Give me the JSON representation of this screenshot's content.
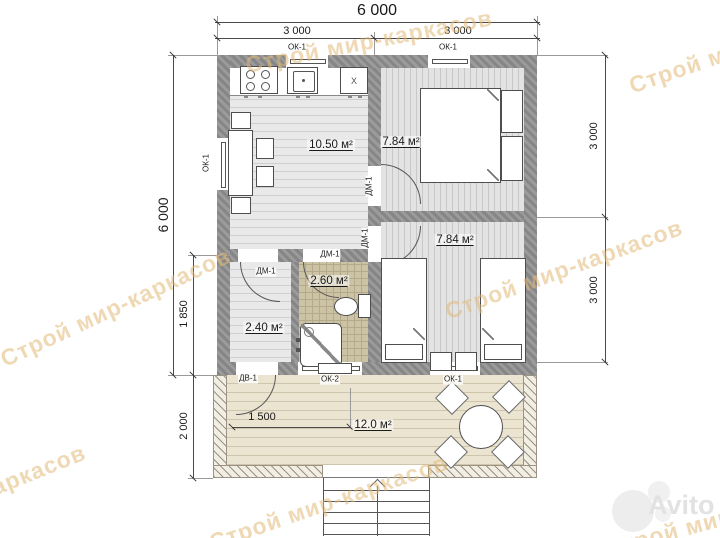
{
  "watermark": {
    "text": "Строй мир-каркасов"
  },
  "brand": {
    "logo_text": "Avito"
  },
  "dims": {
    "top_total": "6 000",
    "top_left_span": "3 000",
    "top_right_span": "3 000",
    "left_total": "6 000",
    "hall_height": "1 850",
    "terrace_height": "2 000",
    "right_top": "3 000",
    "right_bottom": "3 000",
    "terrace_inner": "1 500"
  },
  "rooms": {
    "kitchen_living": {
      "area": "10.50 м²"
    },
    "bedroom_top": {
      "area": "7.84 м²"
    },
    "bedroom_bottom": {
      "area": "7.84 м²"
    },
    "bathroom": {
      "area": "2.60 м²"
    },
    "hall": {
      "area": "2.40 м²"
    },
    "terrace": {
      "area": "12.0 м²"
    }
  },
  "openings": {
    "window_1": "ОК-1",
    "window_2": "ОК-2",
    "entry_door": "ДВ-1",
    "interior_door": "ДМ-1"
  },
  "fixtures": {
    "cabinet_mark": "X"
  }
}
